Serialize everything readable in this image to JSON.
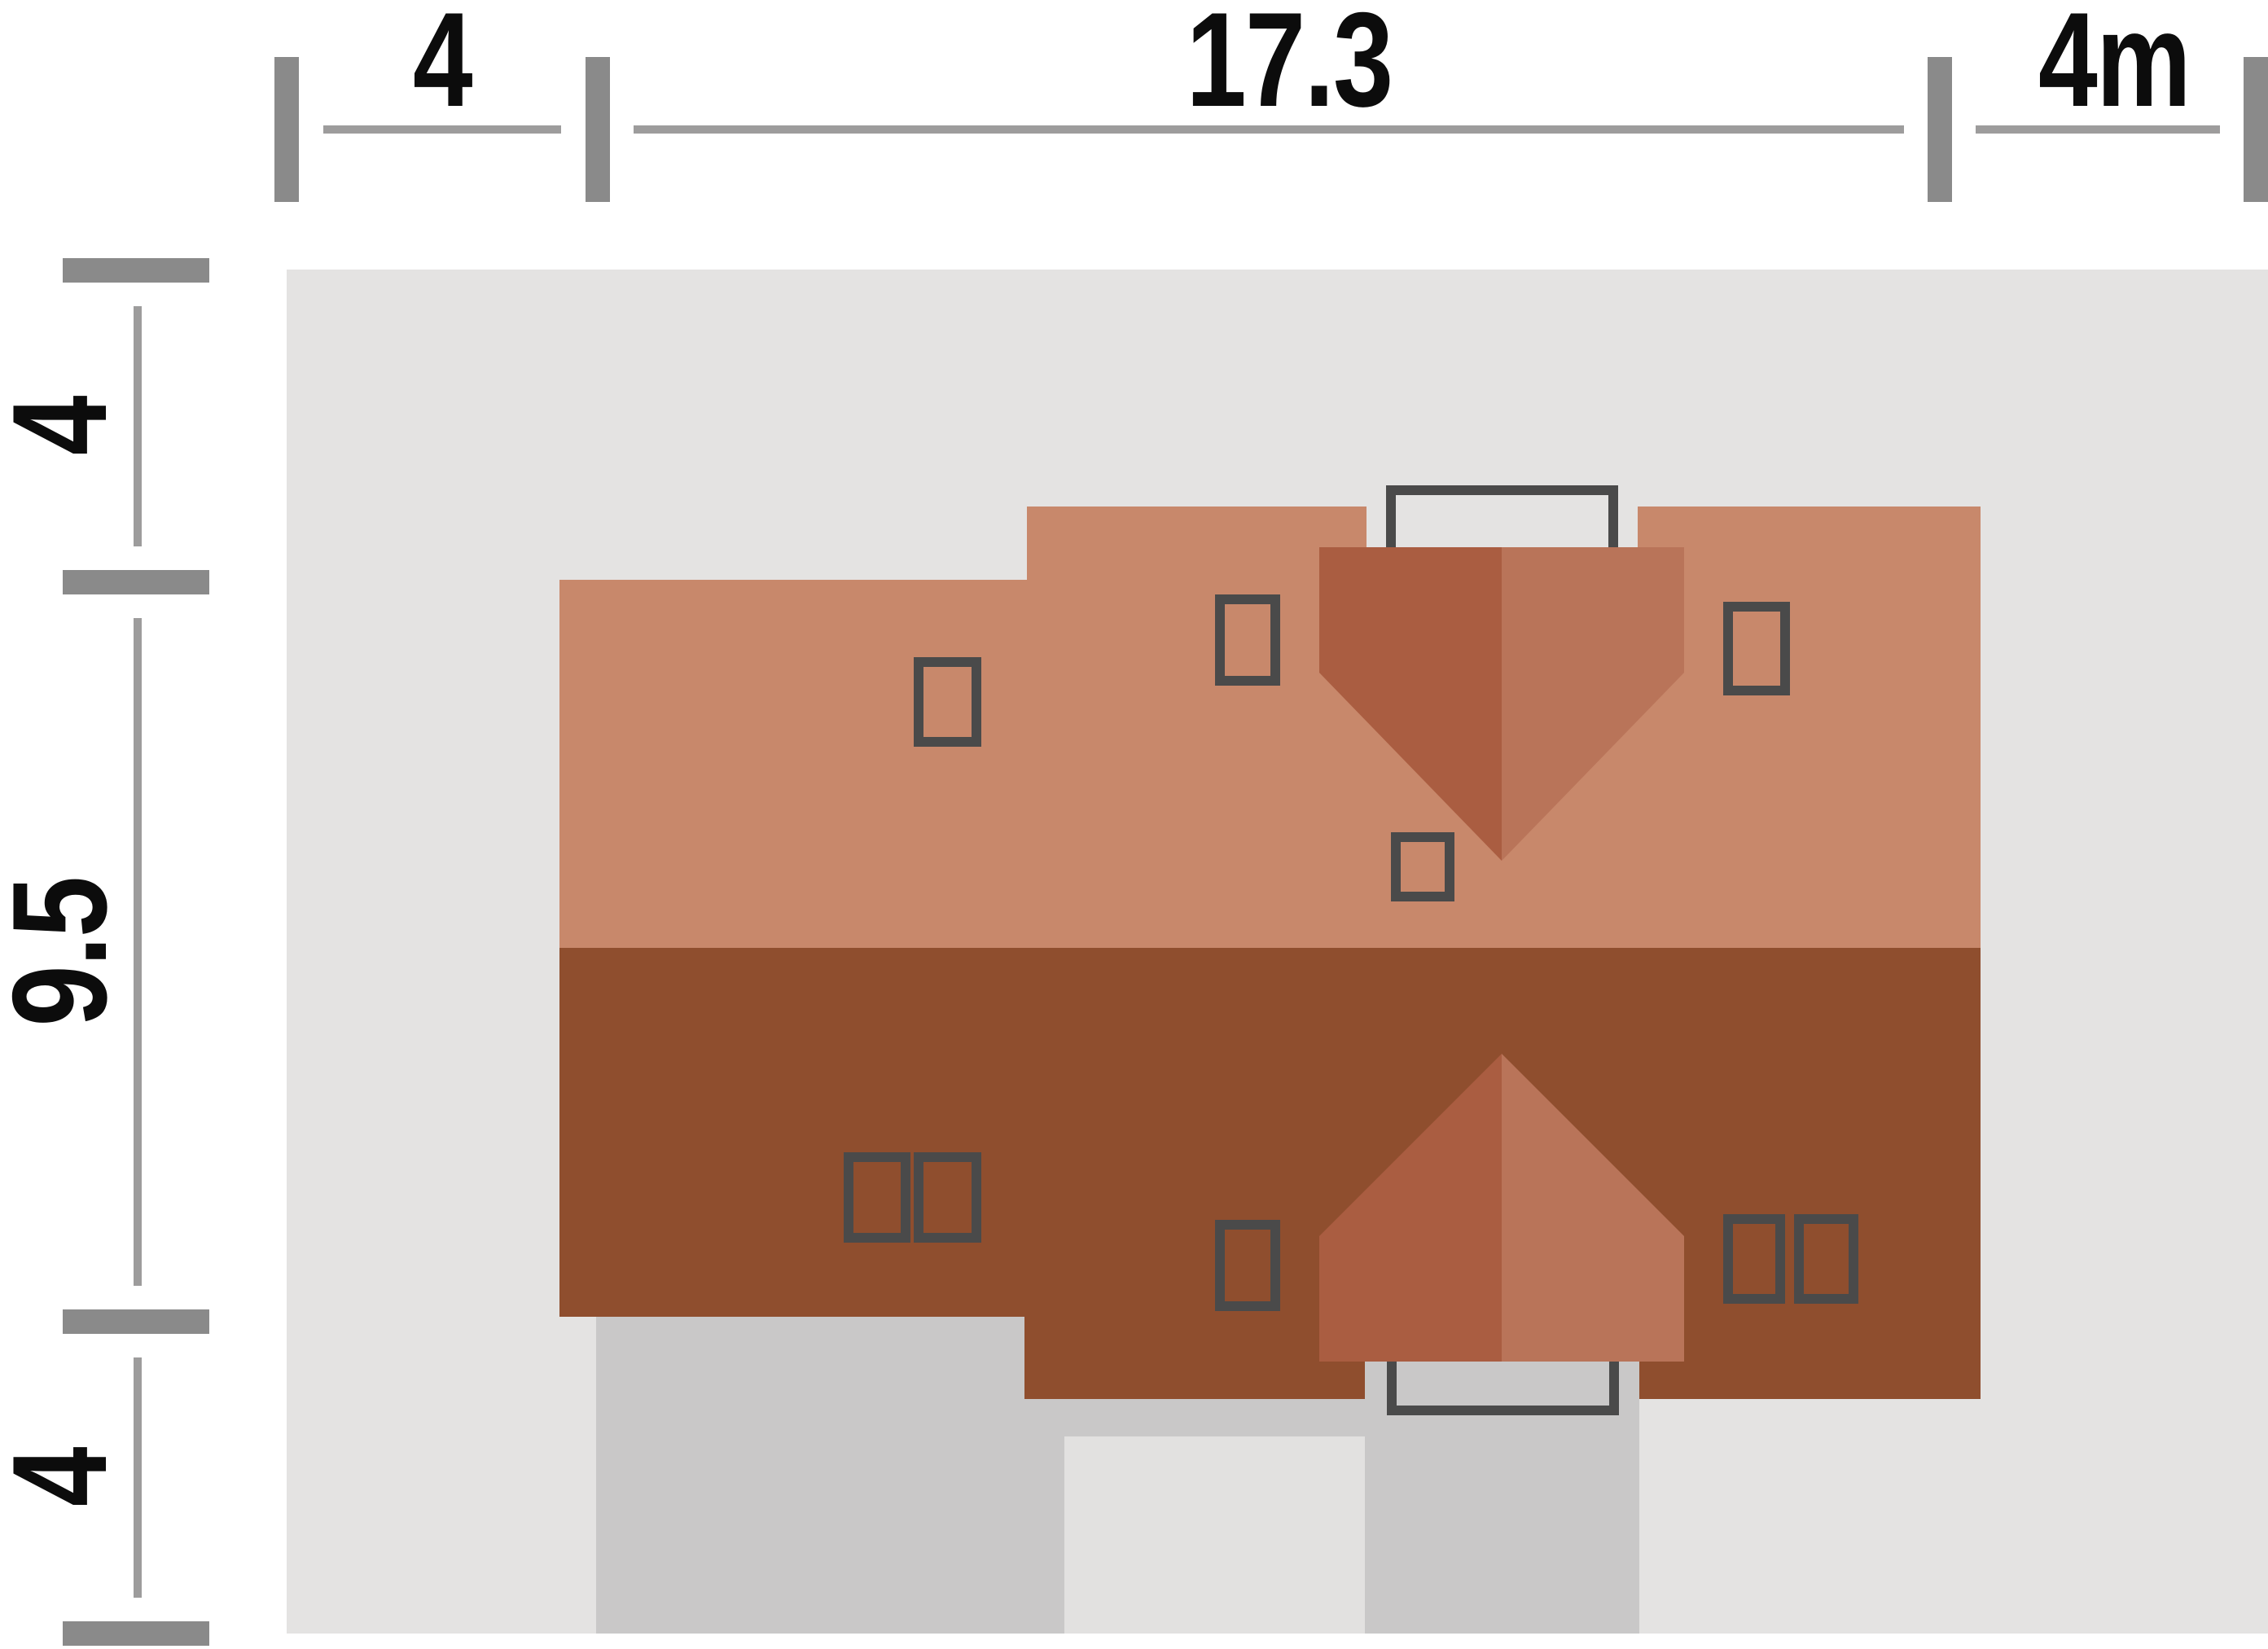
{
  "drawing": {
    "kind": "house-roof-site-plan",
    "units": "m"
  },
  "dimensions_top": {
    "left_margin": "4",
    "house_width": "17.3",
    "right_margin": "4m"
  },
  "dimensions_left": {
    "top_margin": "4",
    "house_depth": "9.5",
    "bottom_margin": "4"
  },
  "colors": {
    "page_bg": "#ffffff",
    "plot_bg": "#e4e3e2",
    "roof_light": "#c8886b",
    "roof_dark": "#8f4e2e",
    "wedge_dark": "#aa5d41",
    "wedge_mid": "#b97459",
    "paving_mid": "#c9c8c8",
    "paving_light": "#e2e1e0",
    "outline": "#4a4a4a",
    "dim_tick": "#8a8a8a",
    "dim_line": "#9d9c9c",
    "dim_text": "#0c0c0c"
  }
}
